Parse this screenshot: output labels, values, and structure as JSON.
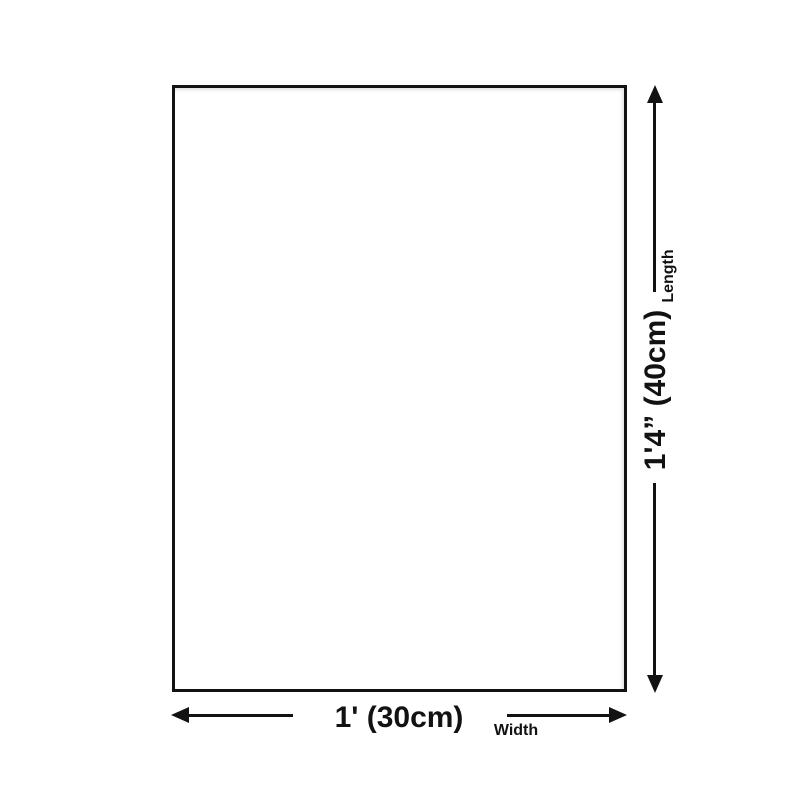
{
  "diagram": {
    "type": "product-dimension-diagram",
    "background_color": "#ffffff",
    "line_color": "#121212",
    "product": {
      "shape": "rectangle",
      "fill": "#ffffff",
      "border": "#121212"
    },
    "length": {
      "value": "1'4” (40cm)",
      "label": "Length",
      "arrow_icons": [
        "arrow-up-icon",
        "arrow-down-icon"
      ]
    },
    "width": {
      "value": "1' (30cm)",
      "label": "Width",
      "arrow_icons": [
        "arrow-left-icon",
        "arrow-right-icon"
      ]
    }
  }
}
